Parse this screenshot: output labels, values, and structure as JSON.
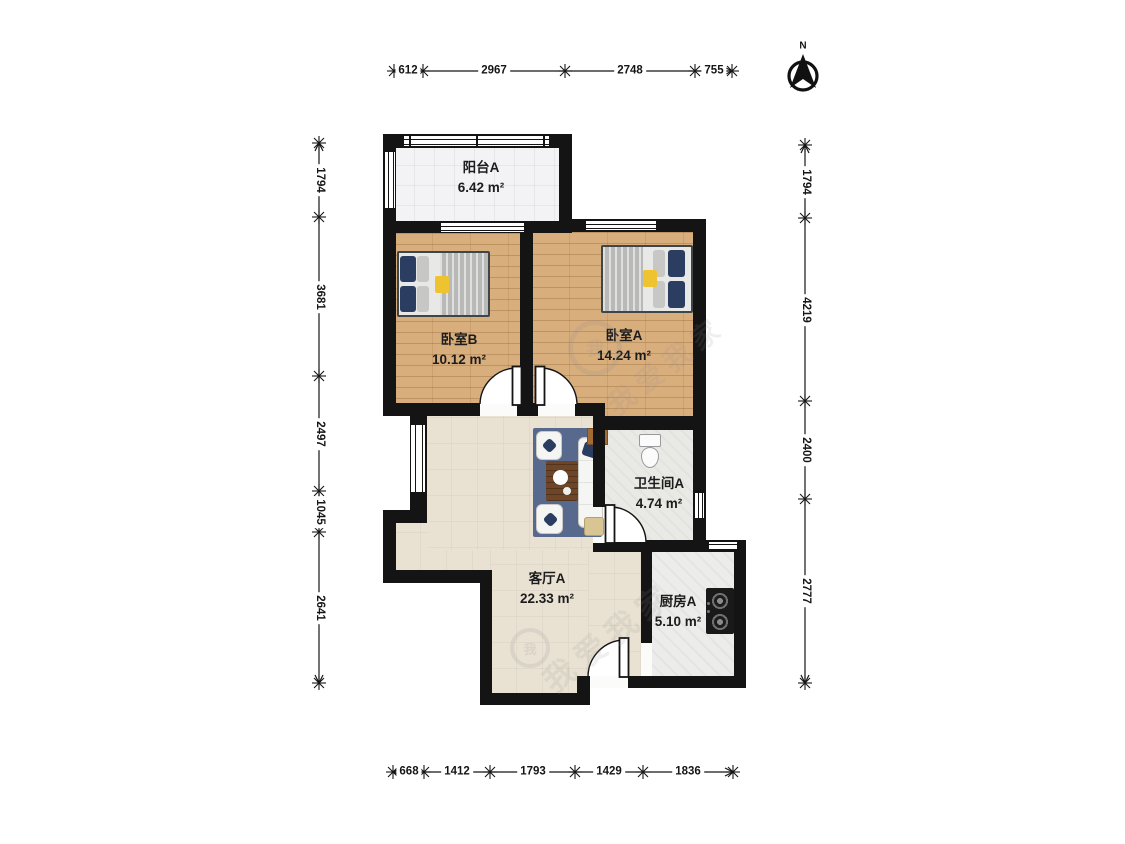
{
  "compass": {
    "label": "N"
  },
  "rooms": {
    "balcony": {
      "name": "阳台A",
      "area": "6.42 m²"
    },
    "bedroom_b": {
      "name": "卧室B",
      "area": "10.12 m²"
    },
    "bedroom_a": {
      "name": "卧室A",
      "area": "14.24 m²"
    },
    "bathroom": {
      "name": "卫生间A",
      "area": "4.74 m²"
    },
    "living": {
      "name": "客厅A",
      "area": "22.33 m²"
    },
    "kitchen": {
      "name": "厨房A",
      "area": "5.10 m²"
    }
  },
  "dimensions_mm": {
    "top": [
      "612",
      "2967",
      "2748",
      "755"
    ],
    "bottom": [
      "668",
      "1412",
      "1793",
      "1429",
      "1836"
    ],
    "left": [
      "1794",
      "3681",
      "2497",
      "1045",
      "2641"
    ],
    "right": [
      "1794",
      "4219",
      "2400",
      "2777"
    ]
  },
  "watermark": {
    "text": "我爱我家",
    "logo_char": "我"
  },
  "colors": {
    "wall": "#141414",
    "wood_floor": "#d9ae7d",
    "living_floor": "#e9e2d3",
    "balcony_floor": "#f3f3f6",
    "tile_floor": "#ececea",
    "rug": "#57698c",
    "pillow_navy": "#2b3d60",
    "accent_yellow": "#edc42f"
  }
}
